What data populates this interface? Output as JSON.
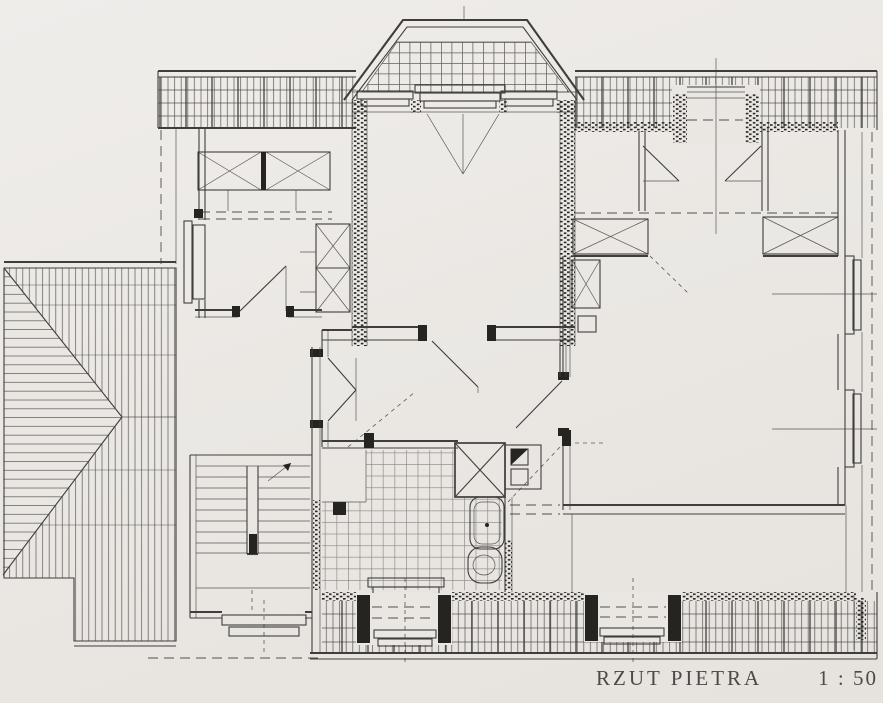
{
  "title_block": {
    "label": "RZUT PIETRA",
    "scale": "1 : 50"
  },
  "palette": {
    "paper": "#eae7e3",
    "ink": "#3f3e3c",
    "ink-light": "#76736f",
    "wall": "#262420"
  }
}
